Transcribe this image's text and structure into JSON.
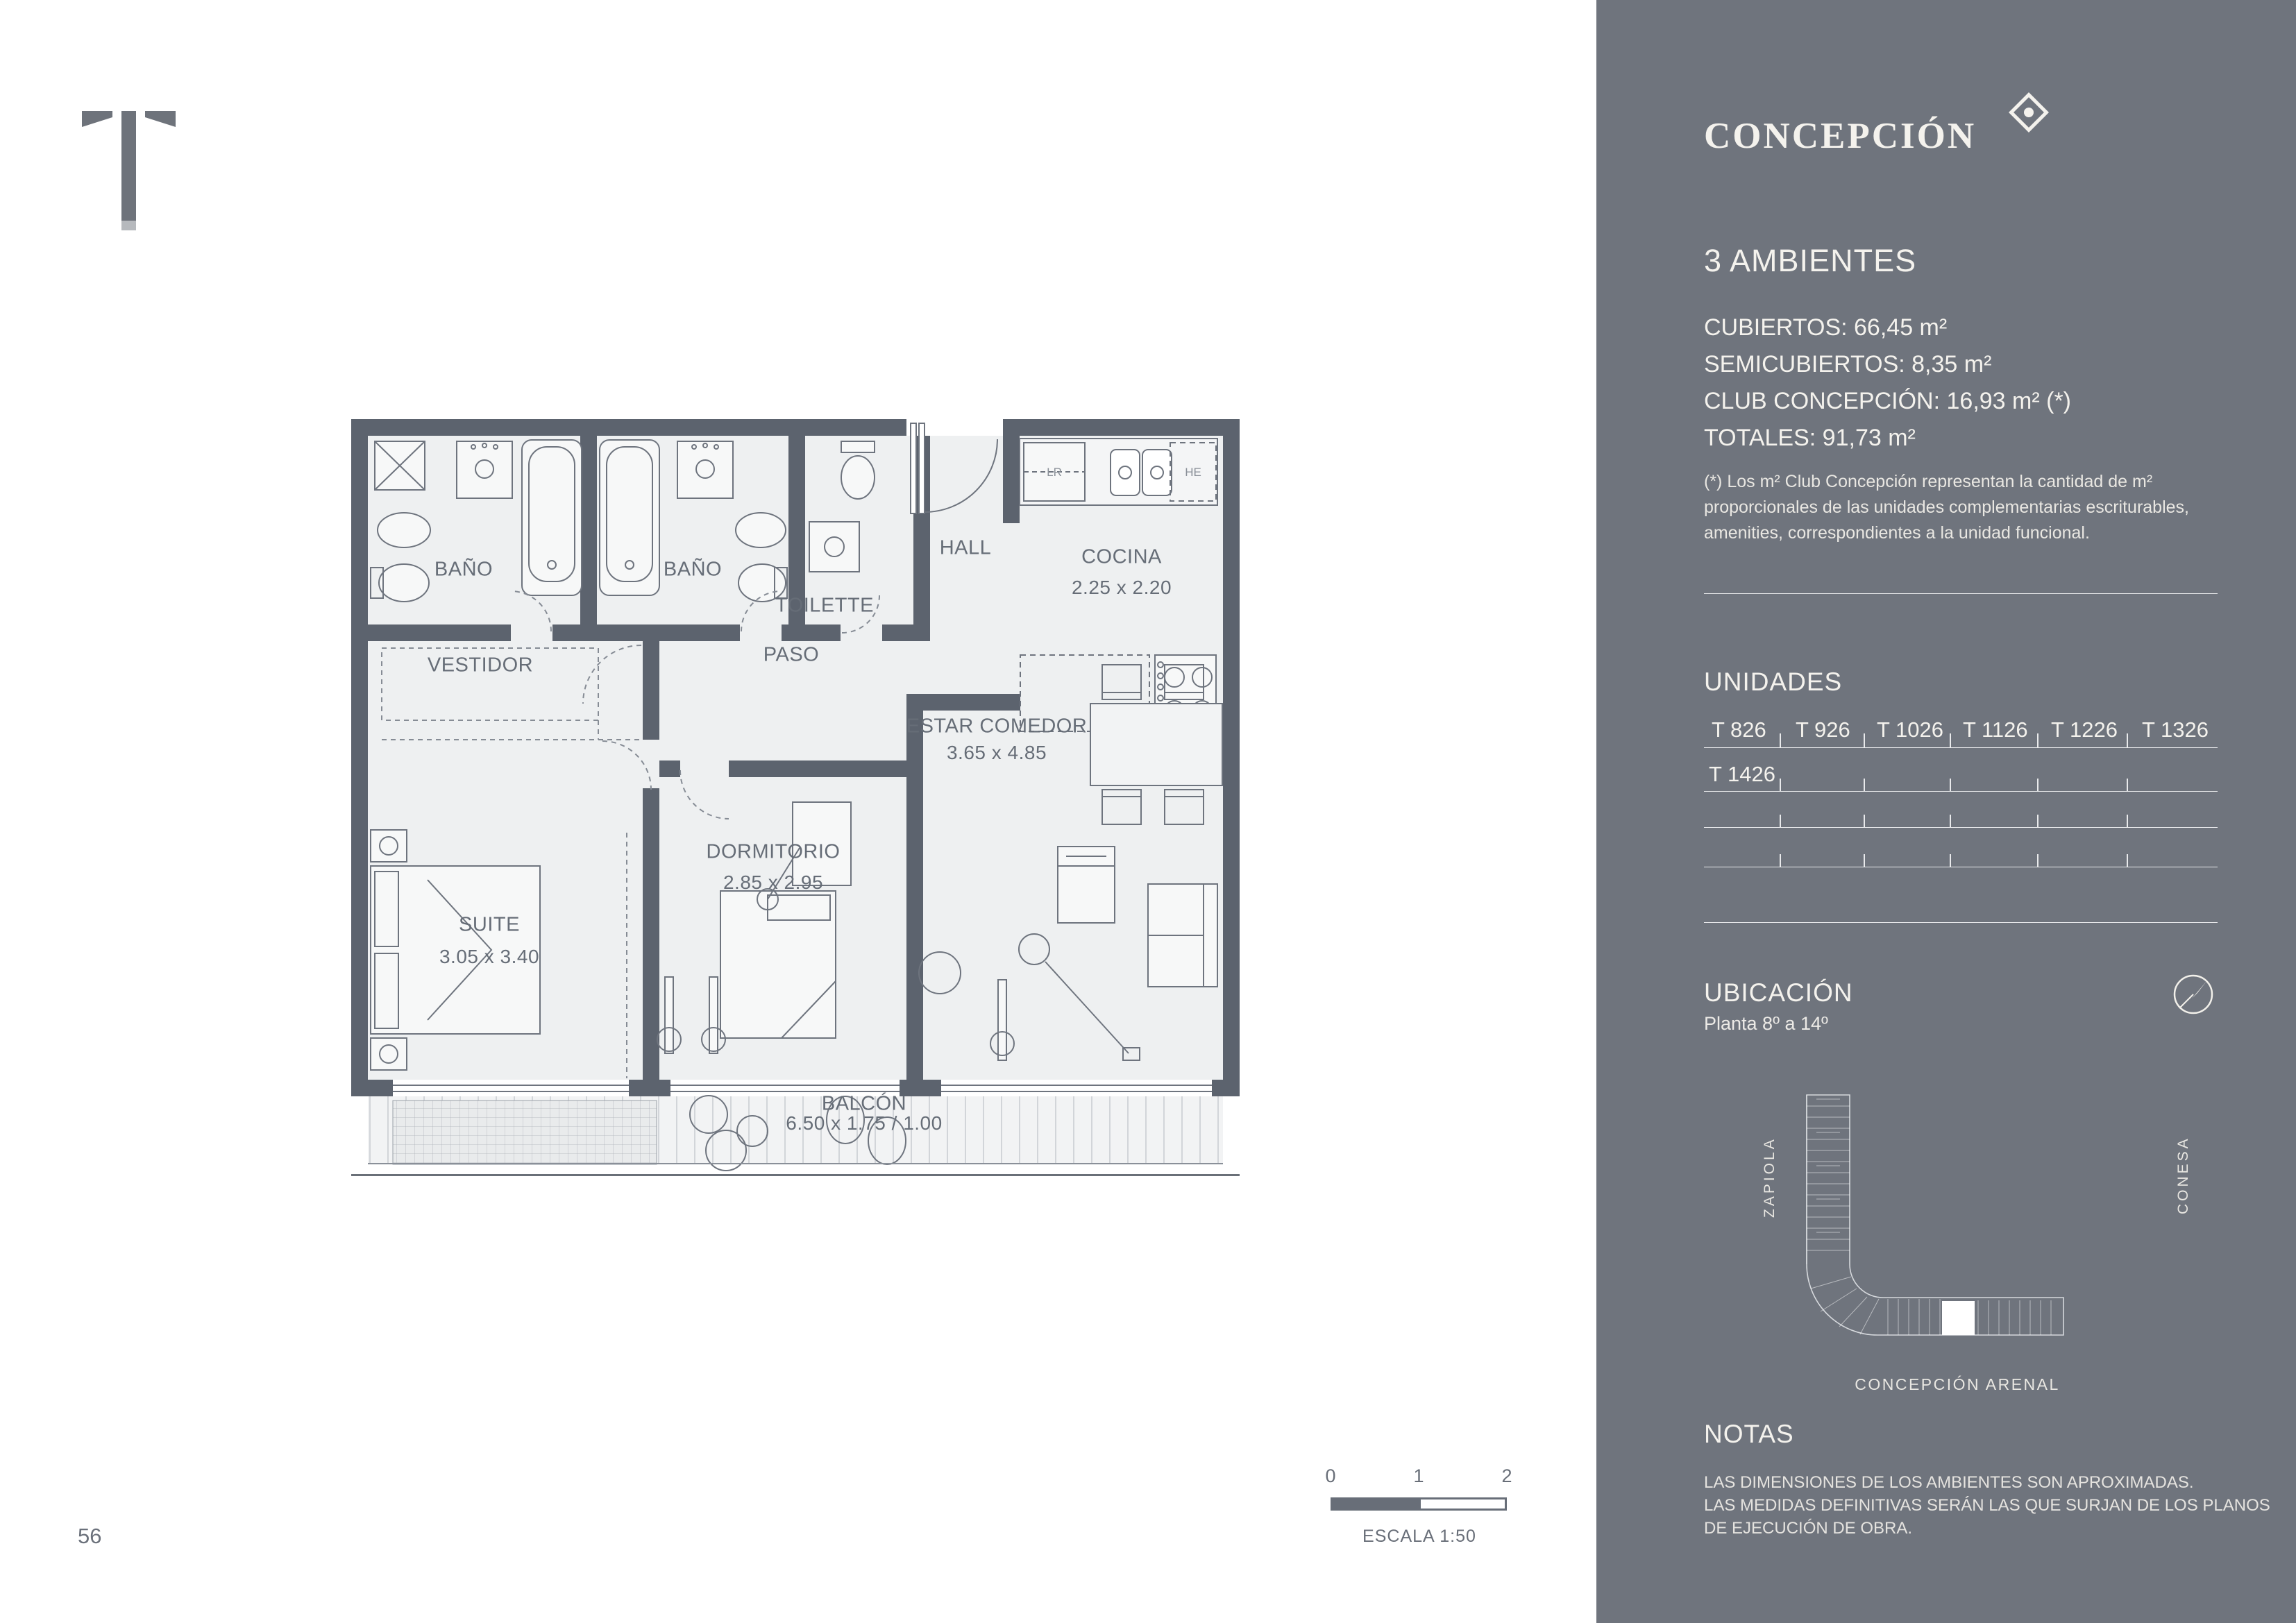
{
  "brand": {
    "t_mark": "T",
    "name": "CONCEPCIÓN"
  },
  "unit": {
    "title": "3 AMBIENTES",
    "areas": [
      "CUBIERTOS: 66,45 m²",
      "SEMICUBIERTOS: 8,35 m²",
      "CLUB CONCEPCIÓN: 16,93 m² (*)",
      "TOTALES: 91,73 m²"
    ],
    "footnote": [
      "(*) Los m² Club Concepción representan la cantidad de m²",
      "proporcionales de las unidades complementarias escriturables,",
      "amenities, correspondientes a la unidad funcional."
    ]
  },
  "unidades": {
    "heading": "UNIDADES",
    "row1": [
      "T 826",
      "T 926",
      "T 1026",
      "T 1126",
      "T 1226",
      "T 1326"
    ],
    "row2": "T 1426"
  },
  "ubicacion": {
    "heading": "UBICACIÓN",
    "floors": "Planta 8º a 14º",
    "street_left": "ZAPIOLA",
    "street_right": "CONESA",
    "street_bottom": "CONCEPCIÓN ARENAL"
  },
  "notas": {
    "heading": "NOTAS",
    "lines": [
      "LAS DIMENSIONES DE LOS AMBIENTES SON APROXIMADAS.",
      "LAS MEDIDAS DEFINITIVAS SERÁN LAS QUE SURJAN DE LOS PLANOS",
      "DE EJECUCIÓN DE OBRA."
    ]
  },
  "plan": {
    "rooms": {
      "bano1": {
        "name": "BAÑO"
      },
      "bano2": {
        "name": "BAÑO"
      },
      "toilette": {
        "name": "TOILETTE"
      },
      "hall": {
        "name": "HALL"
      },
      "cocina": {
        "name": "COCINA",
        "dims": "2.25 x 2.20"
      },
      "vestidor": {
        "name": "VESTIDOR"
      },
      "paso": {
        "name": "PASO"
      },
      "estar": {
        "name": "ESTAR COMEDOR",
        "dims": "3.65 x 4.85"
      },
      "dormitorio": {
        "name": "DORMITORIO",
        "dims": "2.85 x 2.95"
      },
      "suite": {
        "name": "SUITE",
        "dims": "3.05 x 3.40"
      },
      "balcon": {
        "name": "BALCÓN",
        "dims": "6.50 x 1.75 / 1.00"
      }
    },
    "appliances": {
      "fridge": "LR",
      "heater": "HE"
    }
  },
  "scalebar": {
    "ticks": [
      "0",
      "1",
      "2"
    ],
    "label": "ESCALA 1:50"
  },
  "page": {
    "number": "56"
  },
  "colors": {
    "sidebar": "#6f747d",
    "wall": "#5c636e",
    "text_light": "#f4f2ed",
    "plan_text": "#666d77"
  }
}
